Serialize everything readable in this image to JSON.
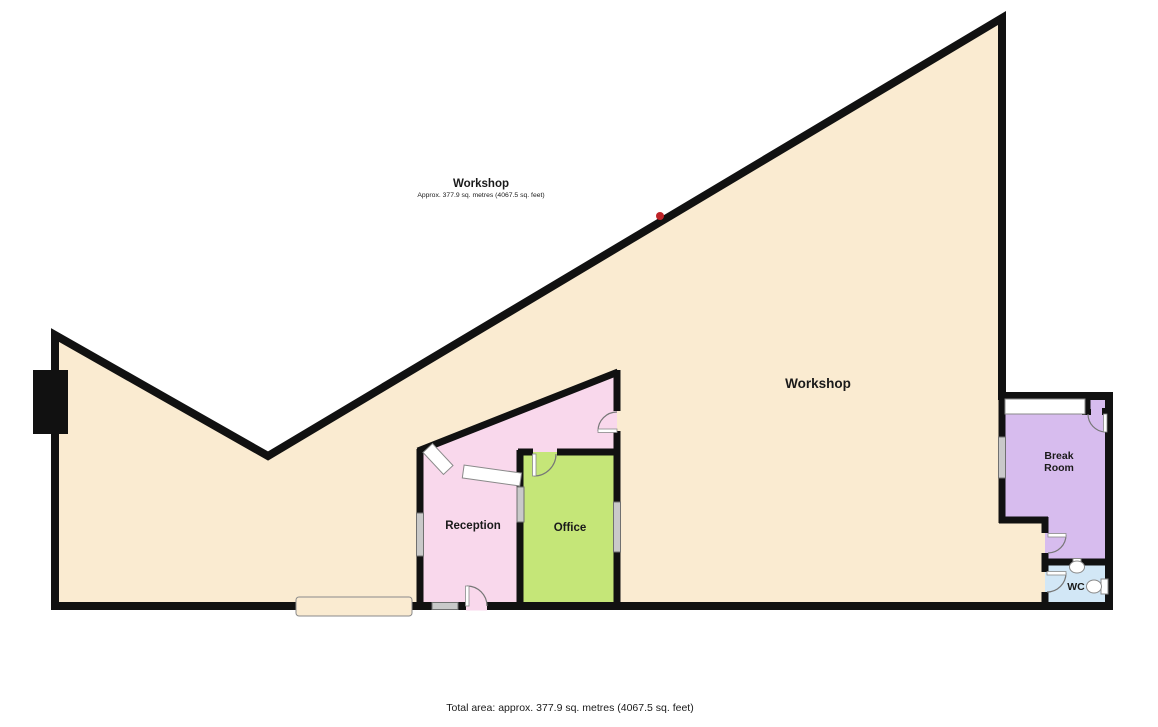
{
  "header": {
    "title": "Workshop",
    "subtitle": "Approx. 377.9 sq. metres (4067.5 sq. feet)"
  },
  "rooms": {
    "workshop": {
      "label": "Workshop"
    },
    "reception": {
      "label": "Reception"
    },
    "office": {
      "label": "Office"
    },
    "break_room": {
      "label_line1": "Break",
      "label_line2": "Room"
    },
    "wc": {
      "label": "WC"
    }
  },
  "footer": {
    "total_area": "Total area: approx. 377.9 sq. metres (4067.5 sq. feet)"
  },
  "colors": {
    "workshop_fill": "#faebd1",
    "reception_fill": "#f9d8ec",
    "office_fill": "#c5e678",
    "break_room_fill": "#d7bcee",
    "wc_fill": "#d2e7f6",
    "wall": "#111111",
    "window_fill": "#c9c9c9",
    "window_border": "#707070",
    "fixture_fill": "#ffffff",
    "fixture_border": "#8a8a8a",
    "door_line": "#777777",
    "marker_red": "#be2328",
    "text": "#1a1a1a"
  }
}
